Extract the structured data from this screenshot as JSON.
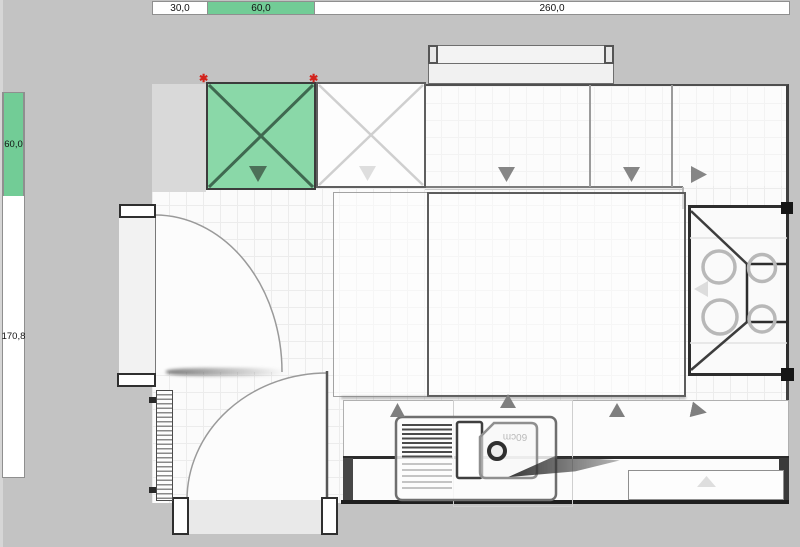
{
  "app": {
    "type": "kitchen-planner-canvas",
    "canvas_color": "#c3c3c3",
    "selection_green": "#8ad8a8",
    "ruler_green": "#72cc96",
    "marker_red": "#d3231c"
  },
  "rulers": {
    "top": {
      "segments": [
        {
          "label": "30,0",
          "selected": false
        },
        {
          "label": "60,0",
          "selected": true
        },
        {
          "label": "260,0",
          "selected": false
        }
      ]
    },
    "left": {
      "segments": [
        {
          "label": "60,0",
          "selected": true
        },
        {
          "label": "170,8",
          "selected": false
        }
      ]
    }
  },
  "plan": {
    "selected_cabinet": {
      "width_label": "60,0",
      "fill": "#8ad8a8"
    },
    "sink_tag_label": "60cm",
    "burner_count": 4,
    "icons": [
      "selection-marker-icon",
      "door-open-direction-arrow",
      "cabinet-cross-top-view"
    ]
  }
}
